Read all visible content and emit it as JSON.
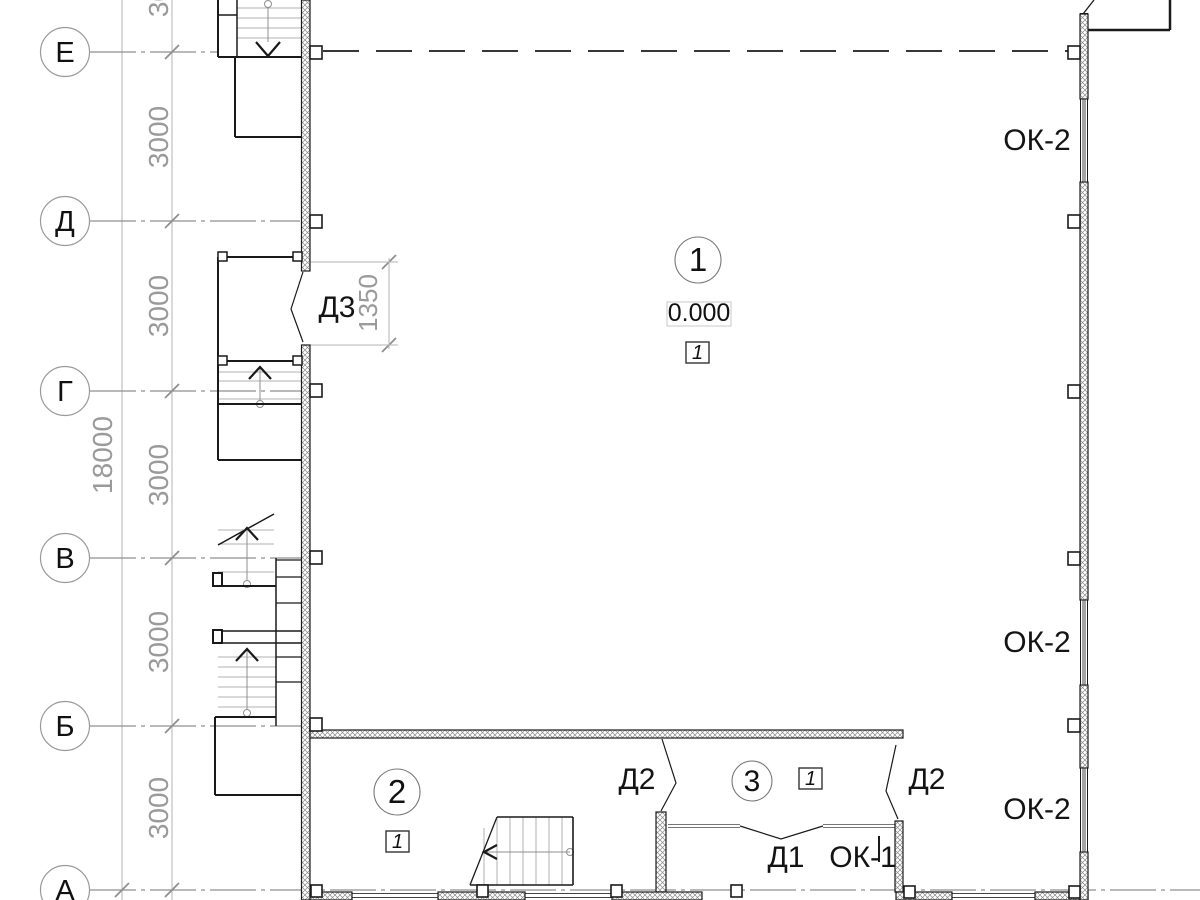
{
  "sheet": {
    "type": "architectural floor plan, ground floor"
  },
  "axes": {
    "items": [
      {
        "label": "Е"
      },
      {
        "label": "Д"
      },
      {
        "label": "Г"
      },
      {
        "label": "В"
      },
      {
        "label": "Б"
      },
      {
        "label": "А"
      }
    ]
  },
  "dims": {
    "bay_labels": [
      "3000",
      "3000",
      "3000",
      "3000",
      "3000",
      "3000"
    ],
    "overall": "18000",
    "door_offset": "1350"
  },
  "rooms": {
    "hall": {
      "number": "1",
      "zone": "1",
      "elevation": "0.000"
    },
    "room2": {
      "number": "2",
      "zone": "1"
    },
    "vestibule": {
      "number": "3",
      "zone": "1"
    }
  },
  "doors": {
    "d1": "Д1",
    "d2": "Д2",
    "d3": "Д3"
  },
  "windows": {
    "ok1": "ОК-1",
    "ok2": "ОК-2"
  },
  "colors": {
    "line": "#1a1a1a",
    "axis": "#8f8f8f",
    "dim_text": "#9a9a9a",
    "tread": "#b0b0b0",
    "hatch": "#8a8a8a"
  }
}
